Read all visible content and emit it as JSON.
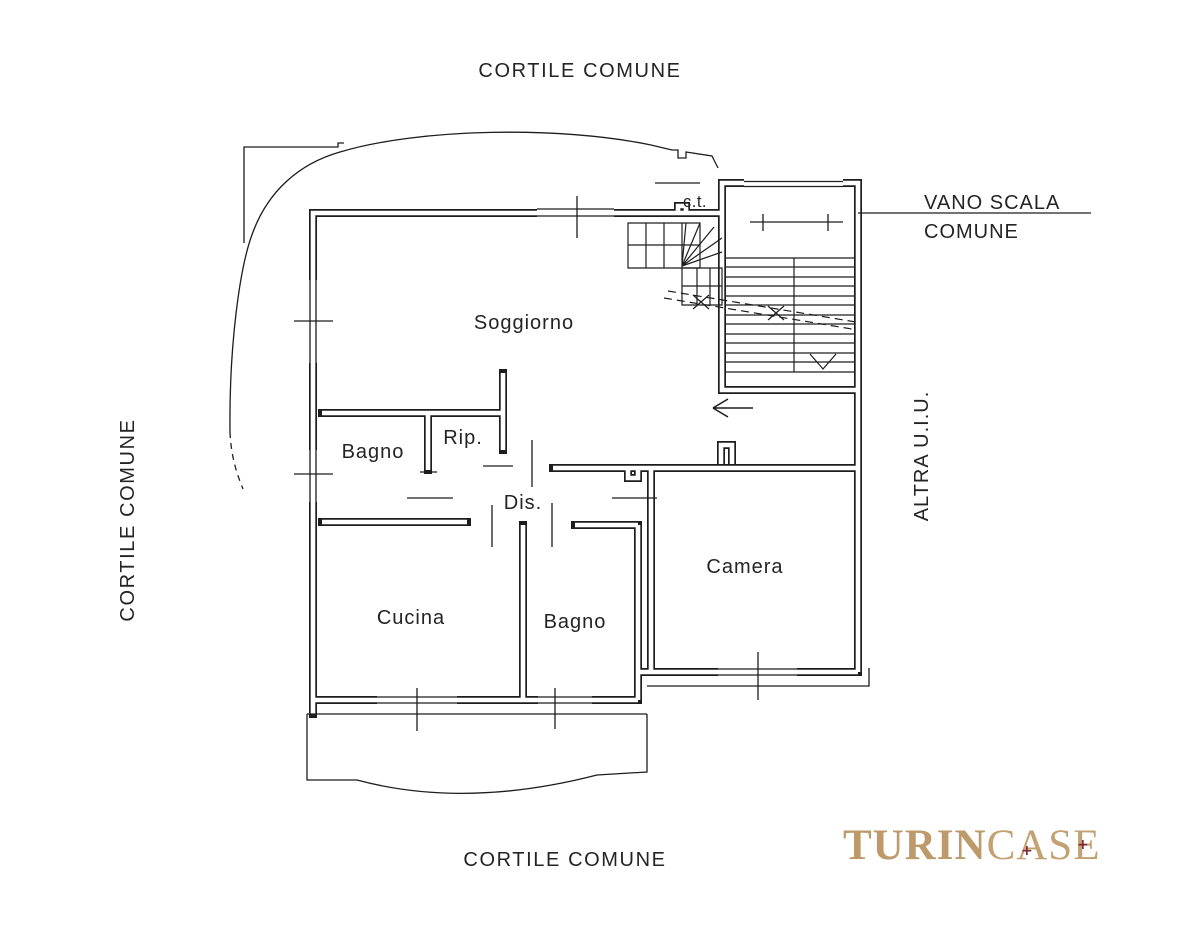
{
  "colors": {
    "background": "#ffffff",
    "line": "#1d1d1d",
    "text": "#242424",
    "logo_gold": "#bc9a6a",
    "logo_accent": "#7d2330"
  },
  "surroundings": {
    "courtyard_top": "CORTILE COMUNE",
    "courtyard_bottom": "CORTILE COMUNE",
    "courtyard_left": "CORTILE COMUNE",
    "other_unit_right": "ALTRA U.I.U."
  },
  "annotations": {
    "stairwell_line1": "VANO SCALA",
    "stairwell_line2": "COMUNE",
    "boiler": "c.t."
  },
  "rooms": {
    "soggiorno": "Soggiorno",
    "bagno_1": "Bagno",
    "rip": "Rip.",
    "dis": "Dis.",
    "cucina": "Cucina",
    "bagno_2": "Bagno",
    "camera": "Camera"
  },
  "logo": {
    "part1": "TURIN",
    "part2": "CASE",
    "accent_symbol": "+"
  }
}
